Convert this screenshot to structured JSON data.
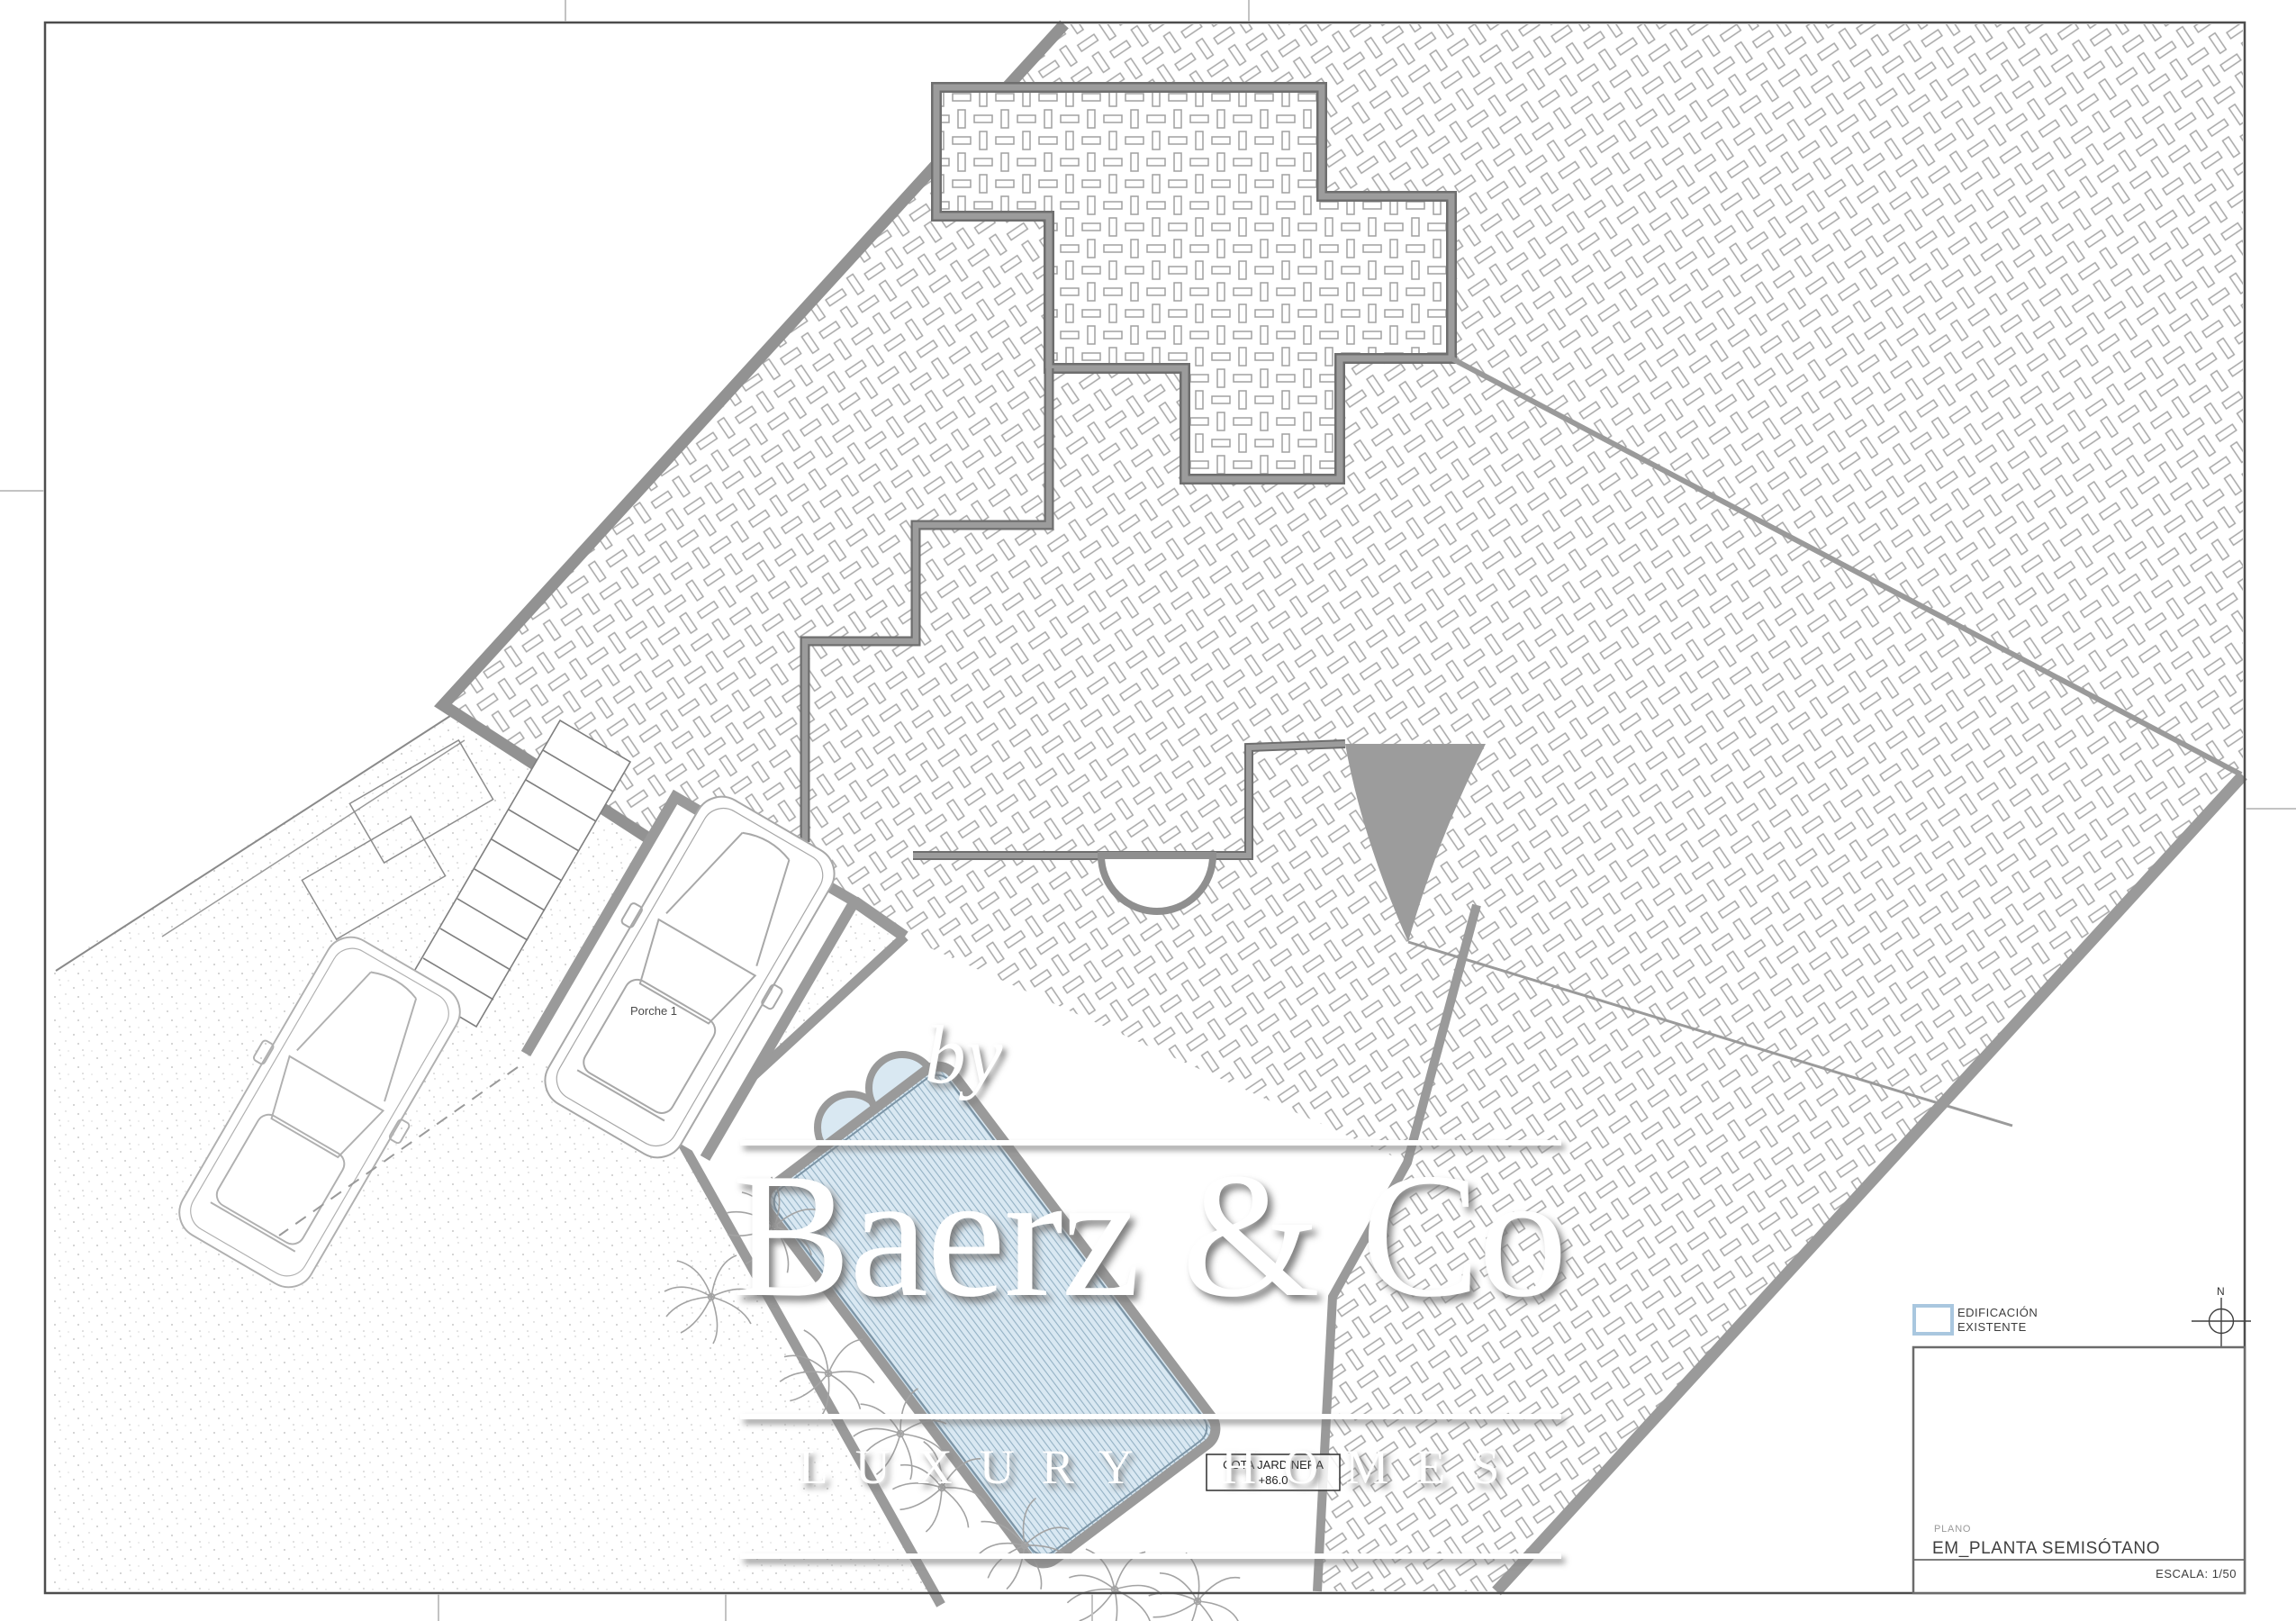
{
  "sheet": {
    "border_color": "#4d4d4d",
    "scale_label": "ESCALA: 1/50",
    "plano_label": "PLANO",
    "plano_value": "EM_PLANTA SEMISÓTANO"
  },
  "legend": {
    "line1": "EDIFICACIÓN",
    "line2": "EXISTENTE",
    "swatch_color": "#a9c7df"
  },
  "compass": {
    "label": "N"
  },
  "plan": {
    "porch_label": "Porche 1",
    "cota_line1": "COTA JARDINERA",
    "cota_line2": "+86.0",
    "pool_color": "#d9e8f2",
    "pool_line_color": "#93b1c4",
    "hatch_color": "#a6a6a6",
    "band_color": "#9a9a9a",
    "wall_color": "#8f8f8f"
  },
  "watermark": {
    "by": "by",
    "name": "Baerz & Co",
    "tagline": "LUXURY HOMES"
  }
}
